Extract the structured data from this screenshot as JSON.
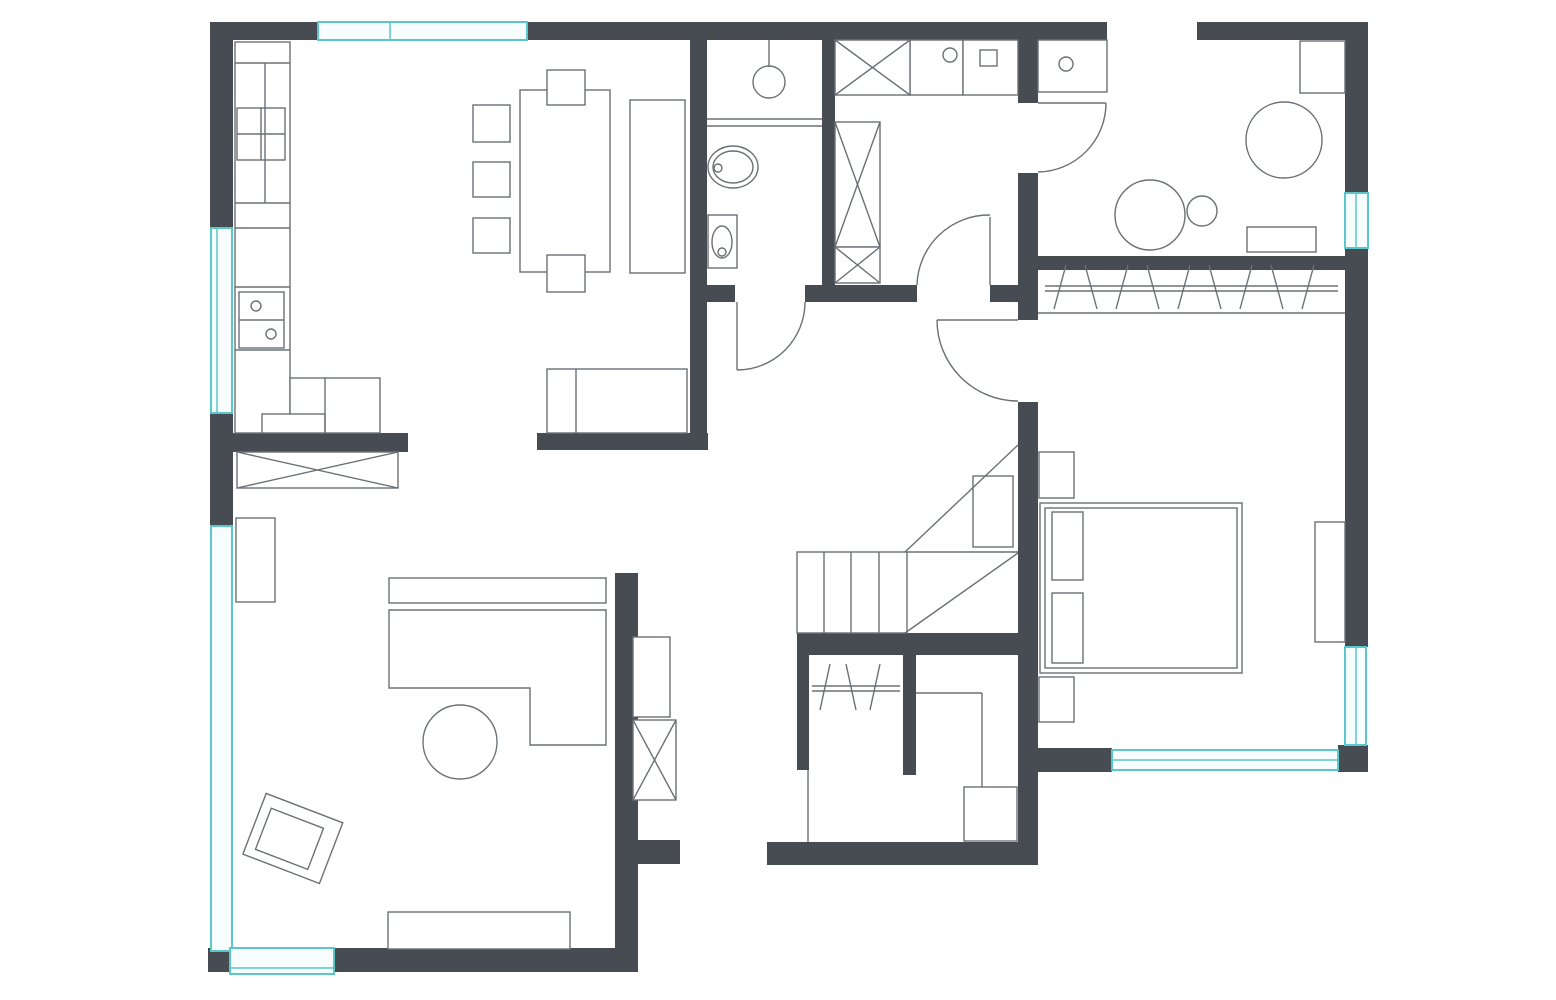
{
  "canvas": {
    "width": 1556,
    "height": 1000,
    "background": "#ffffff"
  },
  "palette": {
    "wall": "#474c52",
    "line": "#6b7075",
    "window_stroke": "#5bc7ca",
    "window_fill": "#f7fdfd",
    "furniture_fill": "#ffffff"
  },
  "floorplan": {
    "walls": [
      {
        "name": "wall-top-left",
        "x": 210,
        "y": 22,
        "w": 108,
        "h": 18
      },
      {
        "name": "wall-top-center",
        "x": 527,
        "y": 22,
        "w": 580,
        "h": 18
      },
      {
        "name": "wall-top-right",
        "x": 1197,
        "y": 22,
        "w": 171,
        "h": 18
      },
      {
        "name": "wall-right-upper",
        "x": 1345,
        "y": 22,
        "w": 23,
        "h": 171
      },
      {
        "name": "wall-right-main",
        "x": 1345,
        "y": 248,
        "w": 23,
        "h": 399
      },
      {
        "name": "wall-right-bottom-corner",
        "x": 1338,
        "y": 745,
        "w": 30,
        "h": 27
      },
      {
        "name": "wall-left-upper",
        "x": 210,
        "y": 22,
        "w": 23,
        "h": 206
      },
      {
        "name": "wall-left-middle",
        "x": 210,
        "y": 413,
        "w": 23,
        "h": 113
      },
      {
        "name": "wall-bottom-left",
        "x": 208,
        "y": 948,
        "w": 430,
        "h": 24
      },
      {
        "name": "wall-bottom-middle",
        "x": 767,
        "y": 842,
        "w": 271,
        "h": 23
      },
      {
        "name": "wall-bedroom-bottom",
        "x": 1018,
        "y": 748,
        "w": 94,
        "h": 24
      },
      {
        "name": "wall-bathroom-left",
        "x": 690,
        "y": 40,
        "w": 17,
        "h": 410
      },
      {
        "name": "wall-bathroom-laundry-divider",
        "x": 822,
        "y": 40,
        "w": 13,
        "h": 245
      },
      {
        "name": "wall-bathroom-bottom-a",
        "x": 707,
        "y": 285,
        "w": 28,
        "h": 17
      },
      {
        "name": "wall-bathroom-bottom-b",
        "x": 805,
        "y": 285,
        "w": 112,
        "h": 17
      },
      {
        "name": "wall-bathroom-bottom-c",
        "x": 990,
        "y": 285,
        "w": 28,
        "h": 17
      },
      {
        "name": "wall-hall-right-a",
        "x": 1018,
        "y": 40,
        "w": 20,
        "h": 63
      },
      {
        "name": "wall-hall-right-b",
        "x": 1018,
        "y": 173,
        "w": 20,
        "h": 147
      },
      {
        "name": "wall-hall-right-c",
        "x": 1018,
        "y": 402,
        "w": 20,
        "h": 440
      },
      {
        "name": "wall-closet-top",
        "x": 1038,
        "y": 256,
        "w": 307,
        "h": 14
      },
      {
        "name": "wall-stairs-bottom",
        "x": 797,
        "y": 633,
        "w": 221,
        "h": 22
      },
      {
        "name": "wall-closet-divider",
        "x": 903,
        "y": 655,
        "w": 13,
        "h": 120
      },
      {
        "name": "wall-closet-left",
        "x": 797,
        "y": 655,
        "w": 12,
        "h": 115
      },
      {
        "name": "wall-living-right",
        "x": 615,
        "y": 573,
        "w": 23,
        "h": 399
      },
      {
        "name": "wall-living-stub",
        "x": 638,
        "y": 840,
        "w": 42,
        "h": 24
      },
      {
        "name": "wall-dining-bottom",
        "x": 537,
        "y": 433,
        "w": 171,
        "h": 17
      },
      {
        "name": "wall-kitchen-bottom",
        "x": 233,
        "y": 433,
        "w": 175,
        "h": 19
      }
    ],
    "windows": [
      {
        "name": "window-top-dining",
        "x": 318,
        "y": 22,
        "w": 209,
        "h": 18,
        "dividers": [
          [
            390,
            22,
            390,
            40
          ]
        ]
      },
      {
        "name": "window-left-kitchen",
        "x": 211,
        "y": 228,
        "w": 21,
        "h": 185,
        "dividers": [
          [
            217,
            228,
            217,
            413
          ]
        ]
      },
      {
        "name": "window-left-living",
        "x": 211,
        "y": 526,
        "w": 21,
        "h": 425,
        "dividers": []
      },
      {
        "name": "window-bottom-living",
        "x": 230,
        "y": 948,
        "w": 104,
        "h": 26,
        "dividers": [
          [
            230,
            968,
            334,
            968
          ]
        ]
      },
      {
        "name": "window-right-top-room",
        "x": 1345,
        "y": 193,
        "w": 23,
        "h": 55,
        "dividers": [
          [
            1356,
            193,
            1356,
            248
          ]
        ]
      },
      {
        "name": "window-right-bedroom",
        "x": 1345,
        "y": 647,
        "w": 21,
        "h": 98,
        "dividers": [
          [
            1356,
            647,
            1356,
            745
          ]
        ]
      },
      {
        "name": "window-bedroom-bottom",
        "x": 1112,
        "y": 750,
        "w": 226,
        "h": 20,
        "dividers": [
          [
            1112,
            760,
            1338,
            760
          ]
        ]
      }
    ],
    "rects": [
      {
        "name": "kitchen-counter",
        "x": 235,
        "y": 42,
        "w": 55,
        "h": 391
      },
      {
        "name": "kitchen-fridge",
        "x": 237,
        "y": 108,
        "w": 48,
        "h": 52
      },
      {
        "name": "kitchen-sink-unit",
        "x": 239,
        "y": 292,
        "w": 45,
        "h": 56
      },
      {
        "name": "kitchen-return-counter",
        "x": 290,
        "y": 378,
        "w": 90,
        "h": 55
      },
      {
        "name": "kitchen-low-cabinet",
        "x": 262,
        "y": 414,
        "w": 63,
        "h": 19
      },
      {
        "name": "dining-table",
        "x": 520,
        "y": 90,
        "w": 90,
        "h": 182
      },
      {
        "name": "dining-chair-left-1",
        "x": 473,
        "y": 105,
        "w": 37,
        "h": 37
      },
      {
        "name": "dining-chair-left-2",
        "x": 473,
        "y": 162,
        "w": 37,
        "h": 35
      },
      {
        "name": "dining-chair-left-3",
        "x": 473,
        "y": 218,
        "w": 37,
        "h": 35
      },
      {
        "name": "dining-chair-top",
        "x": 547,
        "y": 70,
        "w": 38,
        "h": 35
      },
      {
        "name": "dining-chair-bottom",
        "x": 547,
        "y": 255,
        "w": 38,
        "h": 37
      },
      {
        "name": "dining-sideboard",
        "x": 630,
        "y": 100,
        "w": 55,
        "h": 173
      },
      {
        "name": "dining-daybed",
        "x": 547,
        "y": 369,
        "w": 140,
        "h": 64
      },
      {
        "name": "bathroom-toilet-tank",
        "x": 708,
        "y": 215,
        "w": 29,
        "h": 53
      },
      {
        "name": "laundry-counter-sink",
        "x": 910,
        "y": 40,
        "w": 53,
        "h": 55
      },
      {
        "name": "laundry-counter-appliance",
        "x": 963,
        "y": 40,
        "w": 55,
        "h": 55
      },
      {
        "name": "laundry-appliance-inner",
        "x": 980,
        "y": 50,
        "w": 17,
        "h": 16
      },
      {
        "name": "utility-counter",
        "x": 1038,
        "y": 40,
        "w": 69,
        "h": 52
      },
      {
        "name": "topright-desk",
        "x": 1300,
        "y": 41,
        "w": 45,
        "h": 52
      },
      {
        "name": "topright-bench",
        "x": 1247,
        "y": 227,
        "w": 69,
        "h": 25
      },
      {
        "name": "stairs-landing",
        "x": 973,
        "y": 476,
        "w": 40,
        "h": 71
      },
      {
        "name": "bed-outer",
        "x": 1040,
        "y": 503,
        "w": 202,
        "h": 170
      },
      {
        "name": "bed-inner",
        "x": 1045,
        "y": 508,
        "w": 192,
        "h": 160
      },
      {
        "name": "bed-pillow-1",
        "x": 1052,
        "y": 512,
        "w": 31,
        "h": 68
      },
      {
        "name": "bed-pillow-2",
        "x": 1052,
        "y": 593,
        "w": 31,
        "h": 70
      },
      {
        "name": "nightstand-top",
        "x": 1039,
        "y": 452,
        "w": 35,
        "h": 46
      },
      {
        "name": "nightstand-bottom",
        "x": 1039,
        "y": 677,
        "w": 35,
        "h": 45
      },
      {
        "name": "bedroom-radiator",
        "x": 1315,
        "y": 522,
        "w": 30,
        "h": 120
      },
      {
        "name": "storage-cabinet",
        "x": 964,
        "y": 787,
        "w": 53,
        "h": 54
      },
      {
        "name": "hall-shelf",
        "x": 633,
        "y": 637,
        "w": 37,
        "h": 80
      },
      {
        "name": "living-shelf",
        "x": 236,
        "y": 518,
        "w": 39,
        "h": 84
      },
      {
        "name": "sofa-back",
        "x": 389,
        "y": 578,
        "w": 217,
        "h": 25
      },
      {
        "name": "tv-bench",
        "x": 388,
        "y": 912,
        "w": 182,
        "h": 37
      }
    ],
    "crossed_rects": [
      {
        "name": "laundry-wardrobe-top",
        "x": 835,
        "y": 40,
        "w": 75,
        "h": 55
      },
      {
        "name": "laundry-wardrobe-tall",
        "x": 835,
        "y": 122,
        "w": 45,
        "h": 125
      },
      {
        "name": "laundry-wardrobe-small",
        "x": 835,
        "y": 247,
        "w": 45,
        "h": 36
      },
      {
        "name": "hall-wardrobe",
        "x": 633,
        "y": 720,
        "w": 43,
        "h": 80
      },
      {
        "name": "living-sideboard",
        "x": 237,
        "y": 452,
        "w": 161,
        "h": 36
      }
    ],
    "circles": [
      {
        "name": "shower-head",
        "cx": 769,
        "cy": 82,
        "r": 16
      },
      {
        "name": "kitchen-sink-bowl-1",
        "cx": 256,
        "cy": 306,
        "r": 5
      },
      {
        "name": "kitchen-sink-bowl-2",
        "cx": 271,
        "cy": 334,
        "r": 5
      },
      {
        "name": "laundry-sink-drain",
        "cx": 950,
        "cy": 55,
        "r": 7
      },
      {
        "name": "utility-sink-drain",
        "cx": 1066,
        "cy": 64,
        "r": 7
      },
      {
        "name": "topright-round-table",
        "cx": 1284,
        "cy": 140,
        "r": 38
      },
      {
        "name": "topright-armchair",
        "cx": 1150,
        "cy": 215,
        "r": 35
      },
      {
        "name": "topright-stool",
        "cx": 1202,
        "cy": 211,
        "r": 15
      },
      {
        "name": "coffee-table",
        "cx": 460,
        "cy": 742,
        "r": 37
      },
      {
        "name": "toilet-flush",
        "cx": 722,
        "cy": 252,
        "r": 4
      },
      {
        "name": "basin-drain",
        "cx": 718,
        "cy": 168,
        "r": 4
      }
    ],
    "ellipses": [
      {
        "name": "basin-outer",
        "cx": 733,
        "cy": 167,
        "rx": 25,
        "ry": 21
      },
      {
        "name": "basin-inner",
        "cx": 733,
        "cy": 167,
        "rx": 20,
        "ry": 16
      },
      {
        "name": "toilet-bowl",
        "cx": 722,
        "cy": 242,
        "rx": 10,
        "ry": 16
      }
    ],
    "polygons": [
      {
        "name": "sofa-body",
        "points": "389,610 606,610 606,745 530,745 530,688 389,688"
      }
    ],
    "rotated_groups": [
      {
        "name": "living-armchair",
        "rotate": "21 293 838",
        "rects": [
          {
            "name": "armchair-outer",
            "x": 252,
            "y": 806,
            "w": 82,
            "h": 65
          },
          {
            "name": "armchair-inner",
            "x": 262,
            "y": 818,
            "w": 56,
            "h": 44
          }
        ]
      }
    ],
    "lines": [
      {
        "name": "kitchen-counter-div-1",
        "x1": 235,
        "y1": 63,
        "x2": 290,
        "y2": 63
      },
      {
        "name": "kitchen-counter-div-2",
        "x1": 235,
        "y1": 203,
        "x2": 290,
        "y2": 203
      },
      {
        "name": "kitchen-counter-div-3",
        "x1": 235,
        "y1": 228,
        "x2": 290,
        "y2": 228
      },
      {
        "name": "kitchen-counter-div-4",
        "x1": 235,
        "y1": 287,
        "x2": 290,
        "y2": 287
      },
      {
        "name": "kitchen-counter-div-5",
        "x1": 235,
        "y1": 350,
        "x2": 290,
        "y2": 350
      },
      {
        "name": "kitchen-counter-div-6",
        "x1": 265,
        "y1": 63,
        "x2": 265,
        "y2": 203
      },
      {
        "name": "kitchen-fridge-cross-v",
        "x1": 261,
        "y1": 108,
        "x2": 261,
        "y2": 160
      },
      {
        "name": "kitchen-fridge-cross-h",
        "x1": 237,
        "y1": 134,
        "x2": 285,
        "y2": 134
      },
      {
        "name": "kitchen-sink-divider",
        "x1": 239,
        "y1": 320,
        "x2": 284,
        "y2": 320
      },
      {
        "name": "kitchen-return-divider",
        "x1": 325,
        "y1": 378,
        "x2": 325,
        "y2": 433
      },
      {
        "name": "daybed-divider",
        "x1": 576,
        "y1": 369,
        "x2": 576,
        "y2": 433
      },
      {
        "name": "shower-stem",
        "x1": 769,
        "y1": 40,
        "x2": 769,
        "y2": 67
      },
      {
        "name": "bath-partition-1",
        "x1": 707,
        "y1": 119,
        "x2": 822,
        "y2": 119
      },
      {
        "name": "bath-partition-2",
        "x1": 707,
        "y1": 126,
        "x2": 822,
        "y2": 126
      },
      {
        "name": "stairs-tread-1",
        "x1": 824,
        "y1": 552,
        "x2": 824,
        "y2": 633
      },
      {
        "name": "stairs-tread-2",
        "x1": 851,
        "y1": 552,
        "x2": 851,
        "y2": 633
      },
      {
        "name": "stairs-tread-3",
        "x1": 879,
        "y1": 552,
        "x2": 879,
        "y2": 633
      },
      {
        "name": "stairs-upper-edge",
        "x1": 907,
        "y1": 552,
        "x2": 1018,
        "y2": 552
      },
      {
        "name": "stairs-break-lower",
        "x1": 905,
        "y1": 633,
        "x2": 1018,
        "y2": 553
      },
      {
        "name": "stairs-break-upper",
        "x1": 905,
        "y1": 552,
        "x2": 1018,
        "y2": 445
      },
      {
        "name": "closet-rail-1",
        "x1": 1045,
        "y1": 286,
        "x2": 1338,
        "y2": 286
      },
      {
        "name": "closet-rail-2",
        "x1": 1045,
        "y1": 291,
        "x2": 1338,
        "y2": 291
      },
      {
        "name": "closet-sill-line",
        "x1": 1038,
        "y1": 313,
        "x2": 1345,
        "y2": 313
      },
      {
        "name": "hanger-1",
        "x1": 1066,
        "y1": 265,
        "x2": 1054,
        "y2": 309
      },
      {
        "name": "hanger-2",
        "x1": 1085,
        "y1": 265,
        "x2": 1097,
        "y2": 309
      },
      {
        "name": "hanger-3",
        "x1": 1128,
        "y1": 265,
        "x2": 1116,
        "y2": 309
      },
      {
        "name": "hanger-4",
        "x1": 1147,
        "y1": 265,
        "x2": 1159,
        "y2": 309
      },
      {
        "name": "hanger-5",
        "x1": 1190,
        "y1": 265,
        "x2": 1178,
        "y2": 309
      },
      {
        "name": "hanger-6",
        "x1": 1209,
        "y1": 265,
        "x2": 1221,
        "y2": 309
      },
      {
        "name": "hanger-7",
        "x1": 1252,
        "y1": 265,
        "x2": 1240,
        "y2": 309
      },
      {
        "name": "hanger-8",
        "x1": 1271,
        "y1": 265,
        "x2": 1283,
        "y2": 309
      },
      {
        "name": "hanger-9",
        "x1": 1314,
        "y1": 265,
        "x2": 1302,
        "y2": 309
      },
      {
        "name": "small-closet-rail-1",
        "x1": 812,
        "y1": 686,
        "x2": 900,
        "y2": 686
      },
      {
        "name": "small-closet-rail-2",
        "x1": 812,
        "y1": 691,
        "x2": 900,
        "y2": 691
      },
      {
        "name": "small-closet-hanger-1",
        "x1": 830,
        "y1": 664,
        "x2": 820,
        "y2": 710
      },
      {
        "name": "small-closet-hanger-2",
        "x1": 846,
        "y1": 664,
        "x2": 856,
        "y2": 710
      },
      {
        "name": "small-closet-hanger-3",
        "x1": 880,
        "y1": 664,
        "x2": 870,
        "y2": 710
      },
      {
        "name": "small-closet-front-line",
        "x1": 808,
        "y1": 770,
        "x2": 808,
        "y2": 842
      },
      {
        "name": "storage-line-h",
        "x1": 916,
        "y1": 693,
        "x2": 982,
        "y2": 693
      },
      {
        "name": "storage-line-v",
        "x1": 982,
        "y1": 693,
        "x2": 982,
        "y2": 787
      }
    ],
    "stairs_outline": {
      "name": "stairs-treads",
      "x": 797,
      "y": 552,
      "w": 110,
      "h": 81
    },
    "doors": [
      {
        "name": "door-bathroom",
        "leaf": [
          737,
          302,
          737,
          370
        ],
        "arc": "M 805 302 A 68 68 0 0 1 737 370"
      },
      {
        "name": "door-laundry",
        "leaf": [
          990,
          285,
          990,
          217
        ],
        "arc": "M 917 285 A 72 72 0 0 1 990 215"
      },
      {
        "name": "door-utility",
        "leaf": [
          1038,
          103,
          1106,
          103
        ],
        "arc": "M 1106 103 A 69 69 0 0 1 1038 172"
      },
      {
        "name": "door-bedroom",
        "leaf": [
          937,
          320,
          1018,
          320
        ],
        "arc": "M 937 320 A 81 81 0 0 0 1018 401"
      }
    ]
  }
}
